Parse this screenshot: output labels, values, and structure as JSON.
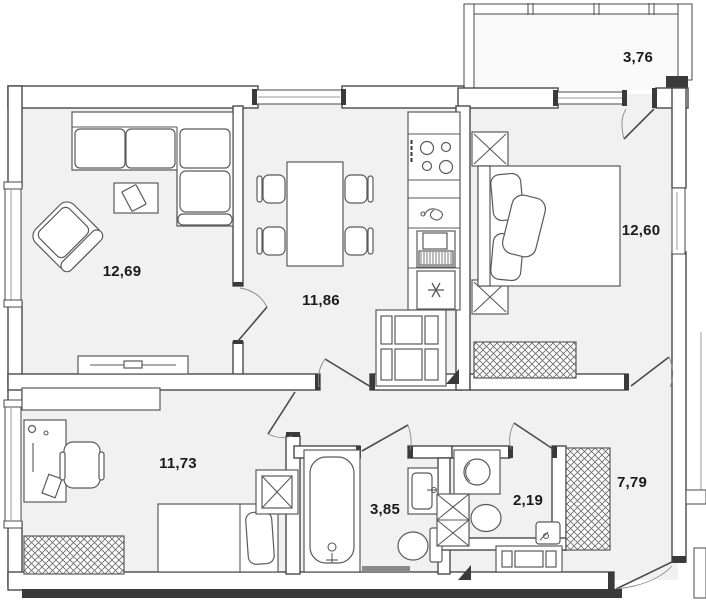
{
  "title": "apartment-floor-plan",
  "rooms": [
    {
      "name": "living-room",
      "area": "12,69"
    },
    {
      "name": "kitchen-dining",
      "area": "11,86"
    },
    {
      "name": "bedroom",
      "area": "12,60"
    },
    {
      "name": "balcony",
      "area": "3,76"
    },
    {
      "name": "second-room",
      "area": "11,73"
    },
    {
      "name": "bathroom",
      "area": "3,85"
    },
    {
      "name": "wc",
      "area": "2,19"
    },
    {
      "name": "hallway",
      "area": "7,79"
    }
  ],
  "icons": {
    "fridge": "snowflake-icon",
    "stove": "burners-icon",
    "sink": "faucet-icon",
    "lamp": "x-lamp-icon",
    "vent": "x-shaft-icon",
    "wardrobe": "diagonal-hatch"
  },
  "colors": {
    "background": "#ffffff",
    "room_fill": "#f1f1f2",
    "balcony_fill": "#fafafa",
    "wall": "#4a4a4a",
    "furniture": "#5a5a5a",
    "label": "#1b1b1b",
    "dark": "#3a3a3a"
  }
}
